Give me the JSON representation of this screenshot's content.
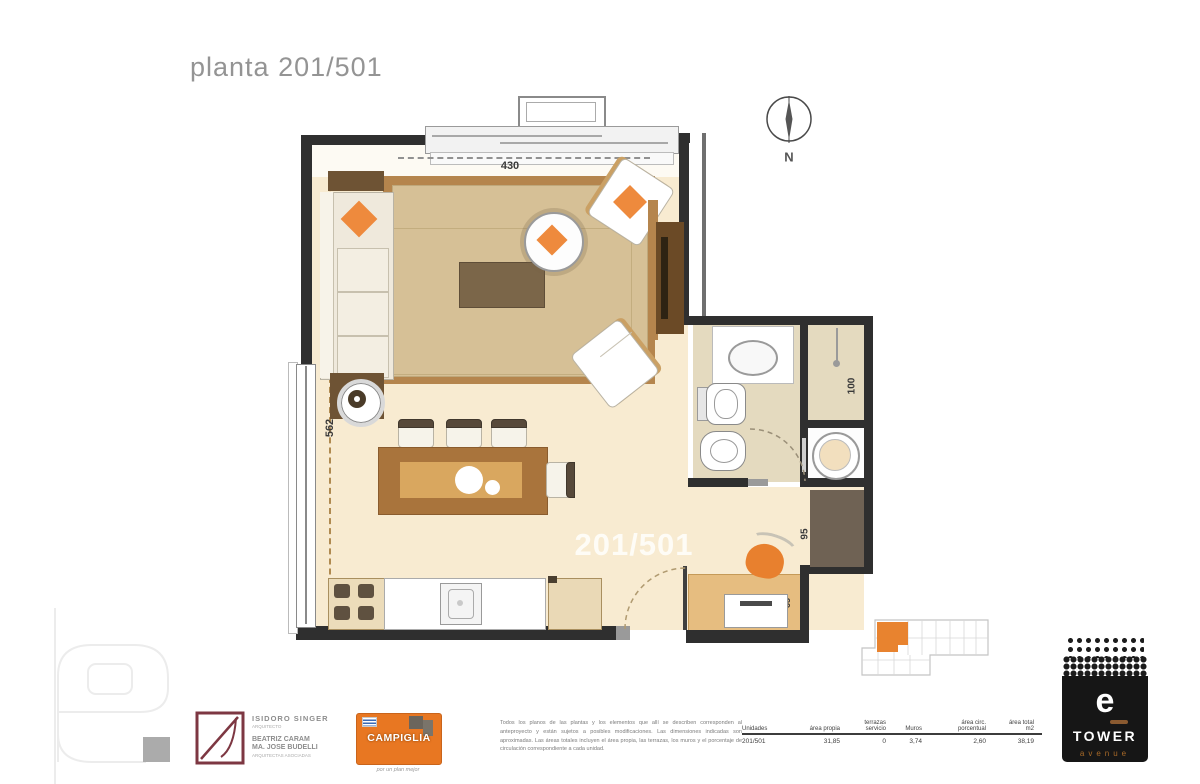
{
  "page_title": "planta 201/501",
  "compass": {
    "north": "N"
  },
  "plan": {
    "unit_label": "201/501",
    "dims": {
      "top": "430",
      "left": "562",
      "bath_sink": "200",
      "bath_side": "175",
      "bath_right": "100",
      "hall": "95",
      "desk_depth": "65",
      "desk_width": "130"
    },
    "colors": {
      "accent_orange": "#e8832f",
      "rug": "#d6c096",
      "wood": "#b5854d",
      "floor_cream": "#f8ebd1",
      "bath_floor": "#e4dabf",
      "wall": "#2f2f2f"
    }
  },
  "footer": {
    "architect": {
      "name": "ISIDORO SINGER",
      "role": "ARQUITECTO",
      "partner1": "BEATRIZ CARAM",
      "partner2": "MA. JOSE BUDELLI",
      "role2": "ARQUITECTAS ASOCIADAS"
    },
    "campiglia": {
      "name": "CAMPIGLIA",
      "tagline": "por un plan mejor"
    },
    "disclaimer": "Todos los planos de las plantas y los elementos que allí se describen corresponden al anteproyecto y están sujetos a posibles modificaciones. Las dimensiones indicadas son aproximadas. Las áreas totales incluyen el área propia, las terrazas, los muros y el porcentaje de circulación correspondiente a cada unidad.",
    "table": {
      "headers": [
        "Unidades",
        "área propia",
        "terrazas\nservicio",
        "Muros",
        "área circ.\nporcentual",
        "área total\nm2"
      ],
      "row": [
        "201/501",
        "31,85",
        "0",
        "3,74",
        "2,60",
        "38,19"
      ]
    },
    "etower": {
      "e": "e",
      "tower": "TOWER",
      "avenue": "avenue"
    }
  }
}
